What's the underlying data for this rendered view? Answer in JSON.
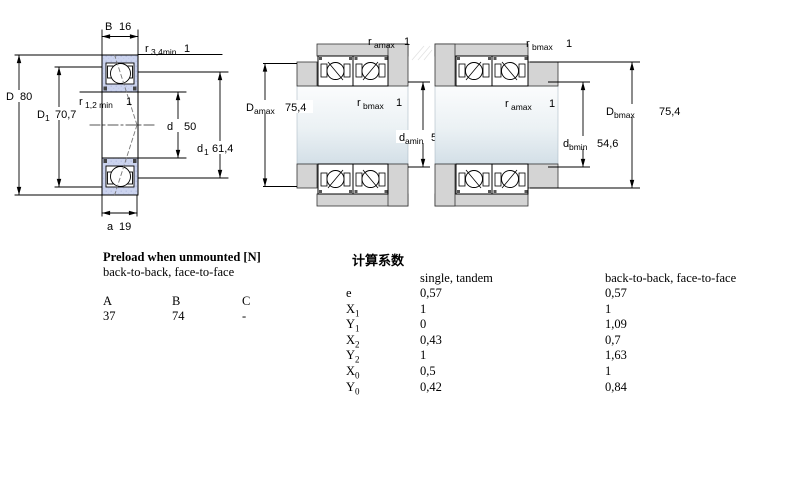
{
  "page": {
    "background": "#ffffff"
  },
  "colors": {
    "ring_blue": "#ccd4ef",
    "ring_speckle": "#b3bce0",
    "housing_gray": "#d4d4d4",
    "shaft_light": "#fbfcfd",
    "shaft_dark": "#d3dfe7",
    "line_black": "#1a1a1a"
  },
  "figures": {
    "single_bearing": {
      "B": {
        "sym": "B",
        "sub": "",
        "value": "16"
      },
      "r34": {
        "sym": "r",
        "sub": "3,4min",
        "value": "1"
      },
      "D": {
        "sym": "D",
        "sub": "",
        "value": "80"
      },
      "D1": {
        "sym": "D",
        "sub": "1",
        "value": "70,7"
      },
      "r12": {
        "sym": "r",
        "sub": "1,2 min",
        "value": "1"
      },
      "d": {
        "sym": "d",
        "sub": "",
        "value": "50"
      },
      "d1": {
        "sym": "d",
        "sub": "1",
        "value": "61,4"
      },
      "a": {
        "sym": "a",
        "sub": "",
        "value": "19"
      }
    },
    "back_to_back": {
      "r_top": {
        "sym": "r",
        "sub": "amax",
        "value": "1"
      },
      "D_left": {
        "sym": "D",
        "sub": "amax",
        "value": "75,4"
      },
      "r_mid": {
        "sym": "r",
        "sub": "bmax",
        "value": "1"
      },
      "d_right": {
        "sym": "d",
        "sub": "amin",
        "value": "54,6"
      }
    },
    "face_to_face": {
      "r_top": {
        "sym": "r",
        "sub": "bmax",
        "value": "1"
      },
      "r_mid": {
        "sym": "r",
        "sub": "amax",
        "value": "1"
      },
      "d_right": {
        "sym": "d",
        "sub": "bmin",
        "value": "54,6"
      },
      "D_right": {
        "sym": "D",
        "sub": "bmax",
        "value": "75,4"
      }
    }
  },
  "preload_table": {
    "title": "Preload when unmounted [N]",
    "subtitle": "back-to-back, face-to-face",
    "columns": [
      "A",
      "B",
      "C"
    ],
    "values": [
      "37",
      "74",
      "-"
    ]
  },
  "factors_table": {
    "title": "计算系数",
    "col1_header": "single, tandem",
    "col2_header": "back-to-back, face-to-face",
    "rows": [
      {
        "sym": "e",
        "sub": "",
        "single": "0,57",
        "paired": "0,57"
      },
      {
        "sym": "X",
        "sub": "1",
        "single": "1",
        "paired": "1"
      },
      {
        "sym": "Y",
        "sub": "1",
        "single": "0",
        "paired": "1,09"
      },
      {
        "sym": "X",
        "sub": "2",
        "single": "0,43",
        "paired": "0,7"
      },
      {
        "sym": "Y",
        "sub": "2",
        "single": "1",
        "paired": "1,63"
      },
      {
        "sym": "X",
        "sub": "0",
        "single": "0,5",
        "paired": "1"
      },
      {
        "sym": "Y",
        "sub": "0",
        "single": "0,42",
        "paired": "0,84"
      }
    ]
  }
}
